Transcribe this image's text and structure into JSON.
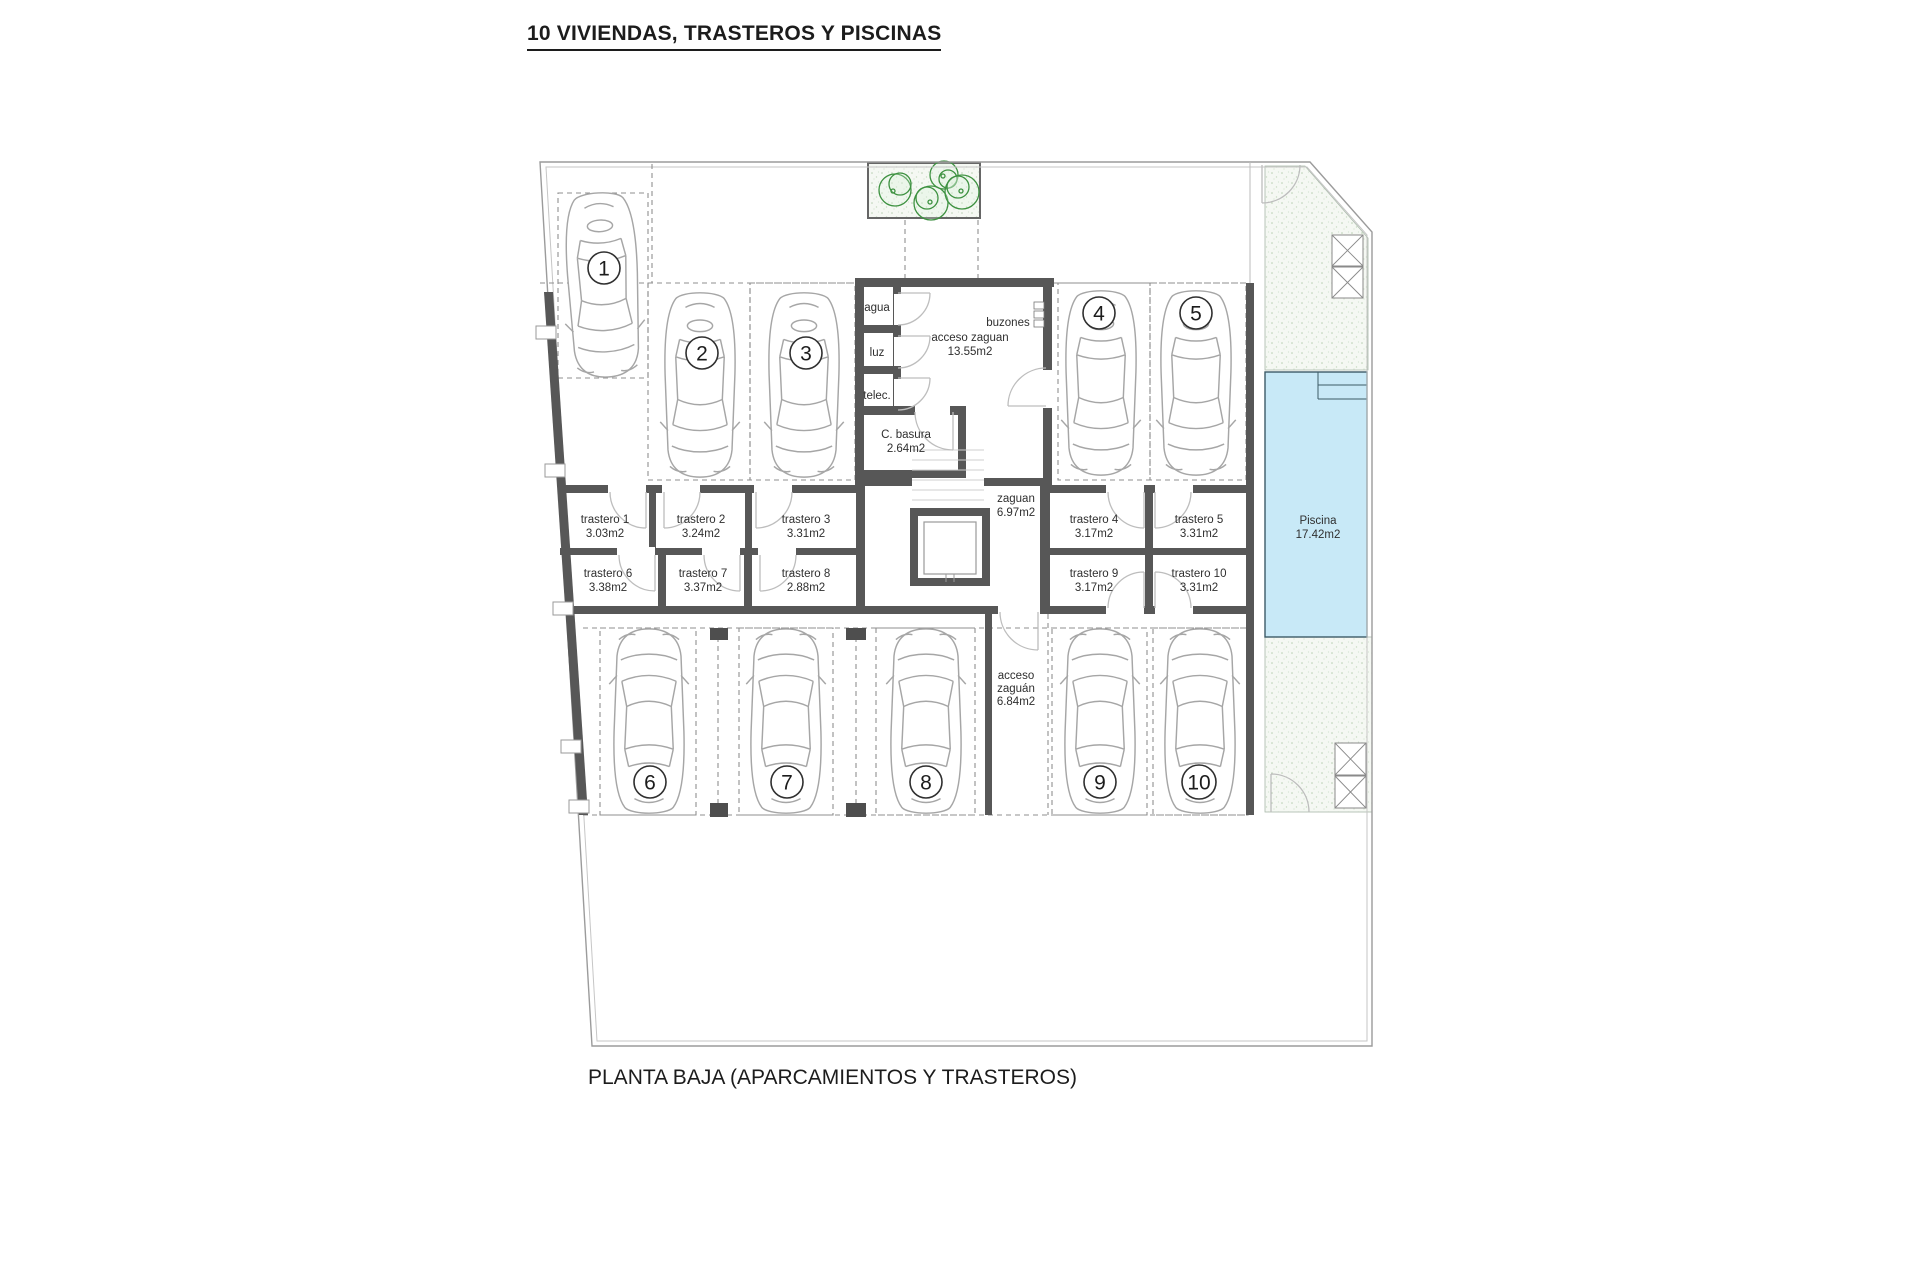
{
  "title": "10 VIVIENDAS, TRASTEROS Y PISCINAS",
  "caption": "PLANTA BAJA (APARCAMIENTOS Y TRASTEROS)",
  "parking_numbers": [
    "1",
    "2",
    "3",
    "4",
    "5",
    "6",
    "7",
    "8",
    "9",
    "10"
  ],
  "trasteros": [
    {
      "name": "trastero 1",
      "area": "3.03m2"
    },
    {
      "name": "trastero 2",
      "area": "3.24m2"
    },
    {
      "name": "trastero 3",
      "area": "3.31m2"
    },
    {
      "name": "trastero 4",
      "area": "3.17m2"
    },
    {
      "name": "trastero 5",
      "area": "3.31m2"
    },
    {
      "name": "trastero 6",
      "area": "3.38m2"
    },
    {
      "name": "trastero 7",
      "area": "3.37m2"
    },
    {
      "name": "trastero 8",
      "area": "2.88m2"
    },
    {
      "name": "trastero 9",
      "area": "3.17m2"
    },
    {
      "name": "trastero 10",
      "area": "3.31m2"
    }
  ],
  "rooms": {
    "agua": "agua",
    "luz": "luz",
    "telec": "telec.",
    "c_basura": {
      "name": "C. basura",
      "area": "2.64m2"
    },
    "acceso_zaguan": {
      "name": "acceso zaguan",
      "area": "13.55m2"
    },
    "buzones": "buzones",
    "zaguan": {
      "name": "zaguan",
      "area": "6.97m2"
    },
    "acceso_zaguan_exterior": {
      "line1": "acceso",
      "line2": "zaguán",
      "area": "6.84m2"
    },
    "piscina": {
      "name": "Piscina",
      "area": "17.42m2"
    }
  },
  "colors": {
    "wall": "#575757",
    "pool": "#c8e9f7",
    "pool_edge": "#3c5a66",
    "plant": "#3d9140"
  }
}
